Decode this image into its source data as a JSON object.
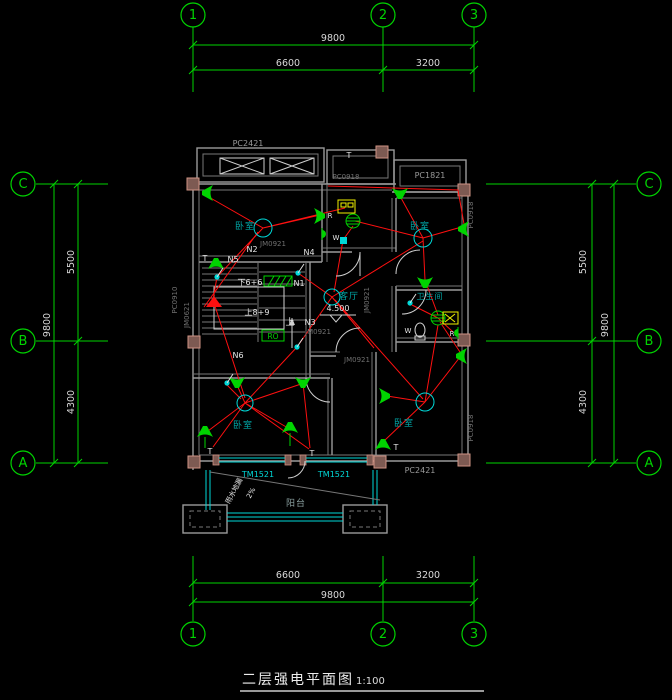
{
  "title_block": {
    "title": "二层强电平面图",
    "scale": "1:100"
  },
  "grid": {
    "cols": [
      {
        "id": "1"
      },
      {
        "id": "2"
      },
      {
        "id": "3"
      }
    ],
    "rows": [
      {
        "id": "C"
      },
      {
        "id": "B"
      },
      {
        "id": "A"
      }
    ],
    "dims": {
      "top_overall": "9800",
      "top_seg1": "6600",
      "top_seg2": "3200",
      "bottom_overall": "9800",
      "bottom_seg1": "6600",
      "bottom_seg2": "3200",
      "left_overall": "9800",
      "left_seg1": "5500",
      "left_seg2": "4300",
      "right_overall": "9800",
      "right_seg1": "5500",
      "right_seg2": "4300"
    }
  },
  "rooms": {
    "bedroom": "卧室",
    "living": "客厅",
    "bath": "卫生间",
    "balcony": "阳台"
  },
  "openings": {
    "pc2421": "PC2421",
    "pc1821": "PC1821",
    "pc0918": "PC0918",
    "pc0910": "PC0910",
    "tm1521": "TM1521",
    "jm0921": "JM0921",
    "jm0621": "JM0621"
  },
  "circuits": {
    "n1": "N1",
    "n2": "N2",
    "n3": "N3",
    "n4": "N4",
    "n5": "N5",
    "n6": "N6"
  },
  "stair": {
    "down": "下6+6",
    "up": "上8+9",
    "up_char": "上"
  },
  "annotations": {
    "level": "4.500",
    "ro": "RO",
    "t": "T",
    "w": "W",
    "r": "R",
    "slope": "2%",
    "drain": "雨水地漏"
  },
  "colors": {
    "grid": "#00d400",
    "wiring": "#ff1010",
    "glazing": "#00d8d8",
    "wall": "#9a9a9a",
    "column_fill": "#7d5a52",
    "column_edge": "#cf9384",
    "accent_yellow": "#f0f000"
  }
}
